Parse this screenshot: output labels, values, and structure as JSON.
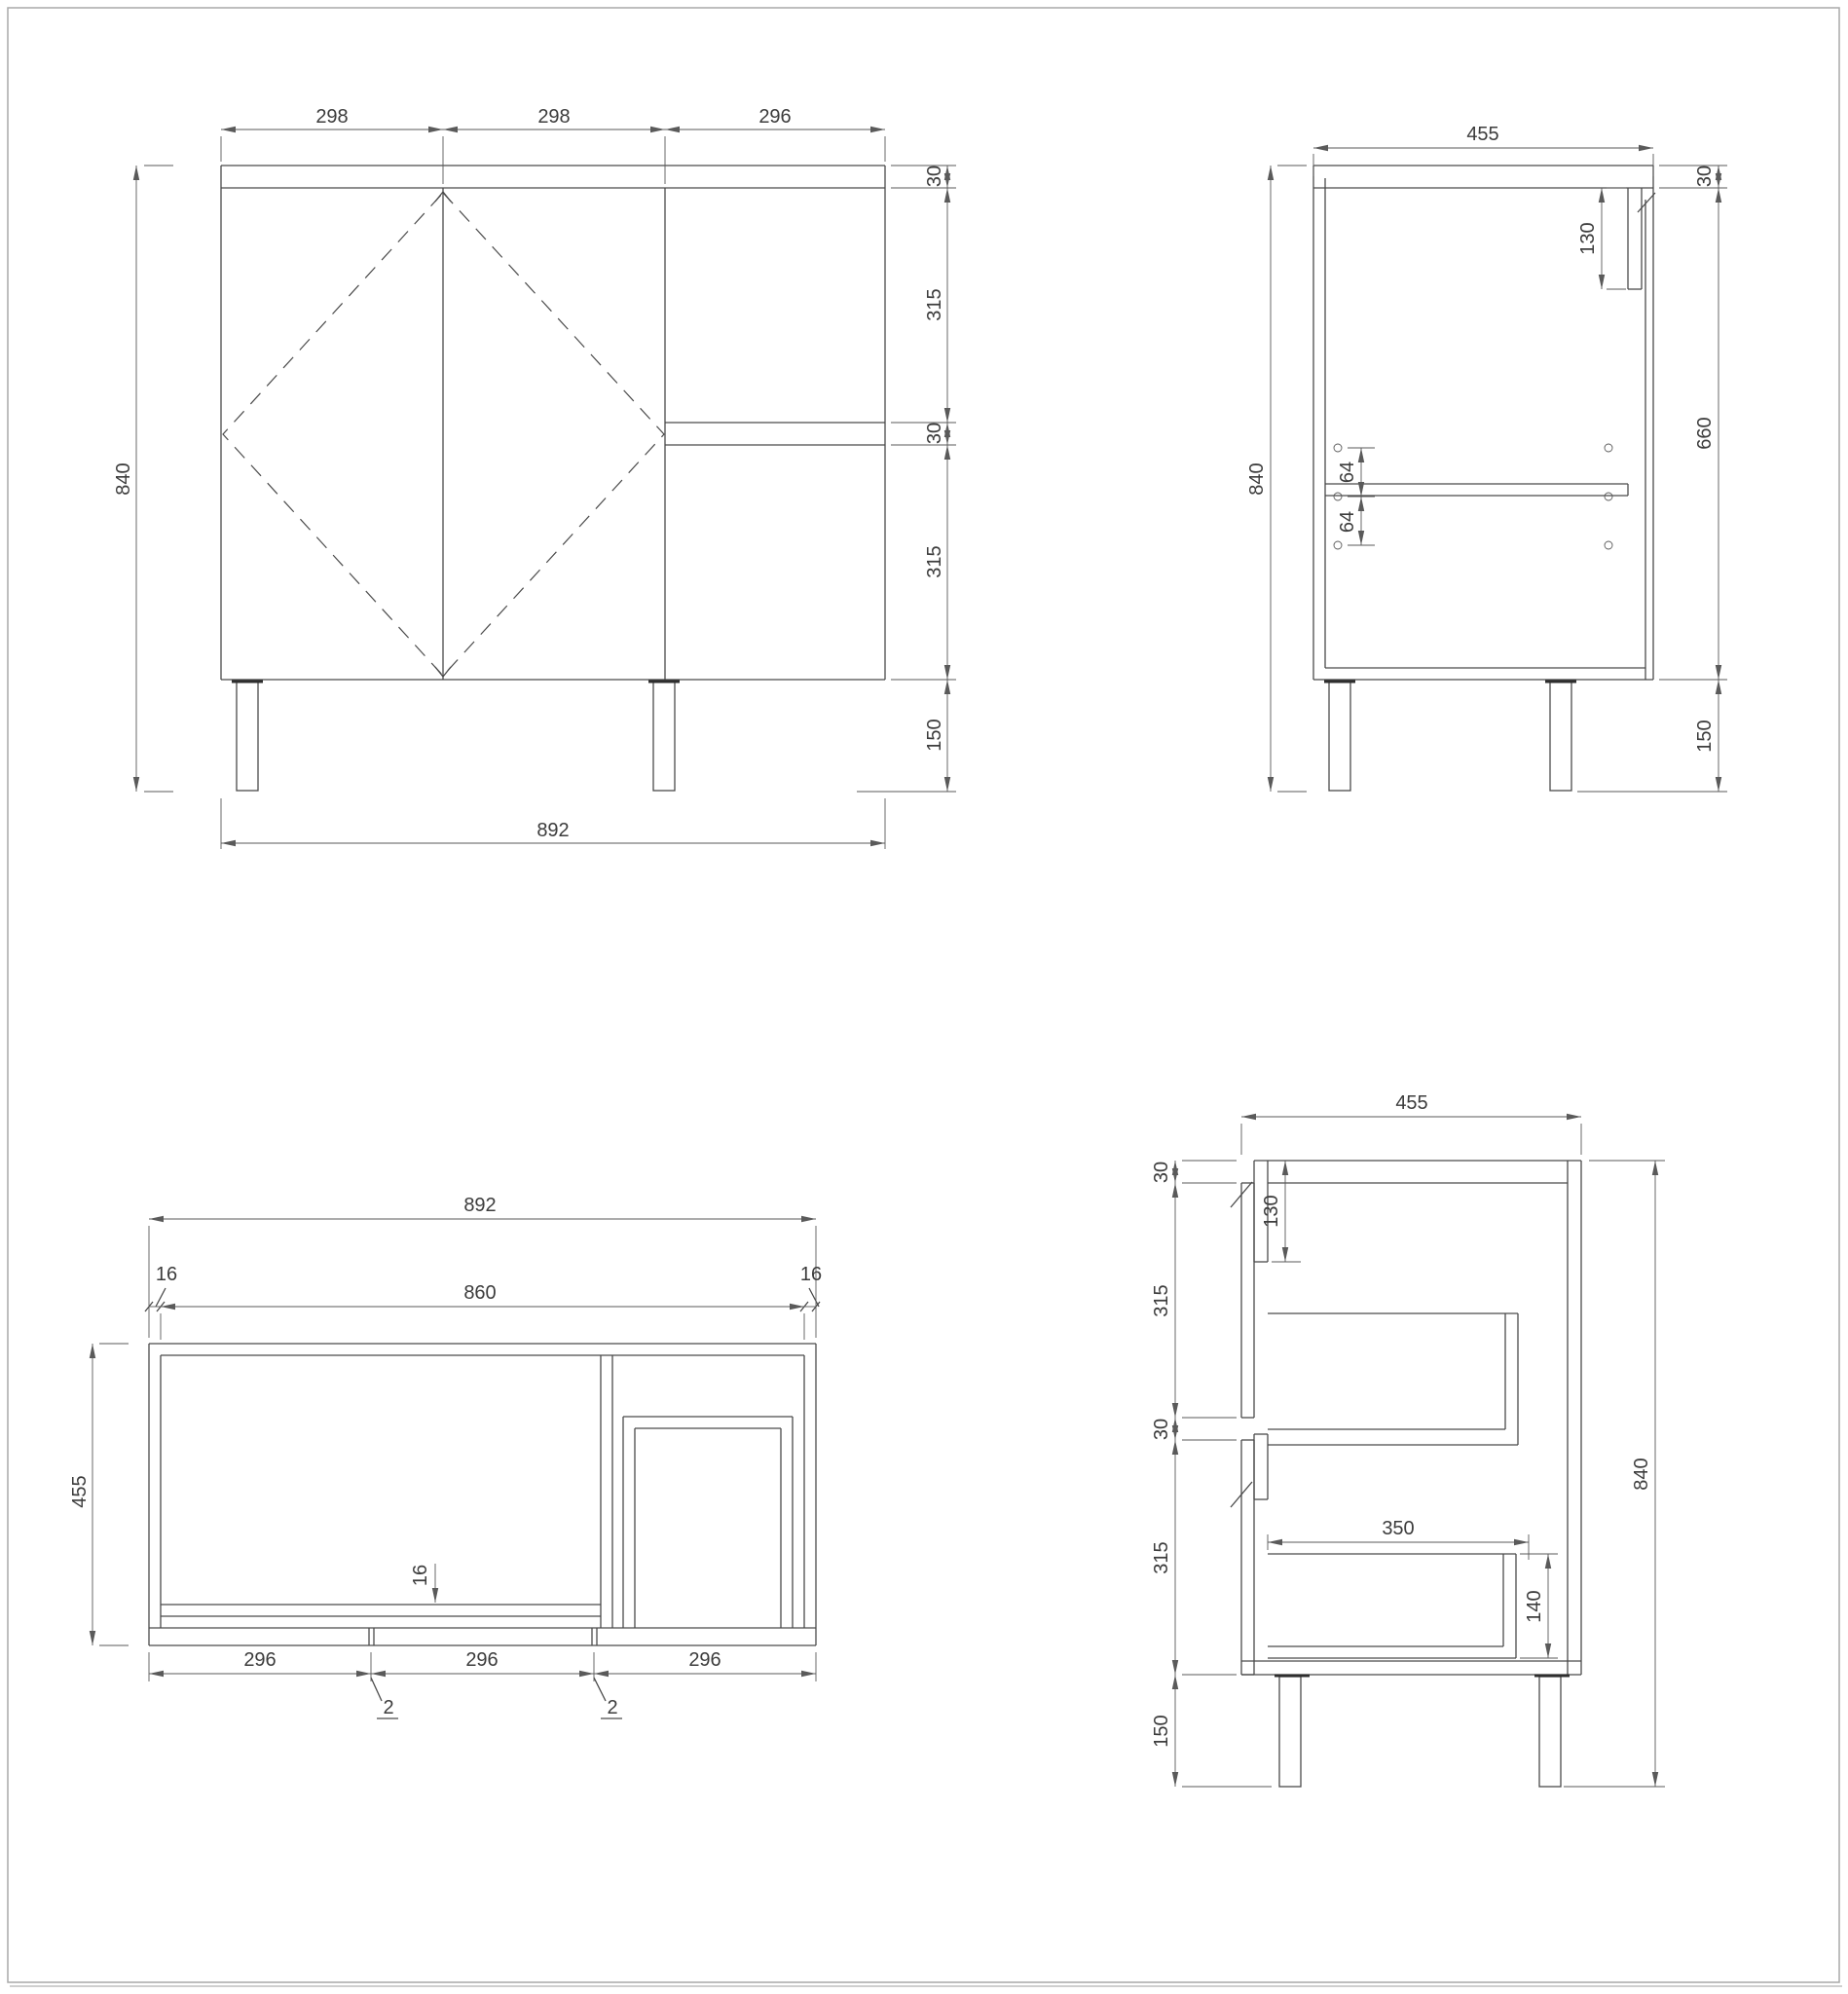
{
  "page": {
    "background": "#ffffff",
    "line_color": "#4a4a4a",
    "text_color": "#3c3c3c",
    "border_color": "#a9a9a9"
  },
  "drawing": {
    "type": "furniture-technical-drawing",
    "views": {
      "front": {
        "dims": {
          "width_segments": [
            "298",
            "298",
            "296"
          ],
          "height": "840",
          "right_stack": [
            "30",
            "315",
            "30",
            "315",
            "150"
          ],
          "total_width": "892"
        }
      },
      "side": {
        "dims": {
          "width": "455",
          "height": "840",
          "rail_height": "130",
          "hole_spacing": [
            "64",
            "64"
          ],
          "right_stack": [
            "30",
            "660",
            "150"
          ]
        }
      },
      "plan": {
        "dims": {
          "total_width": "892",
          "side_thickness": [
            "16",
            "16"
          ],
          "inner_width": "860",
          "depth": "455",
          "panel_thickness": "16",
          "door_widths": [
            "296",
            "296",
            "296"
          ],
          "door_gaps": [
            "2",
            "2"
          ]
        }
      },
      "section": {
        "dims": {
          "width": "455",
          "left_stack": [
            "30",
            "315",
            "30",
            "315",
            "150"
          ],
          "height": "840",
          "rail_height": "130",
          "drawer_depth": "350",
          "drawer_box_height": "140"
        }
      }
    }
  }
}
